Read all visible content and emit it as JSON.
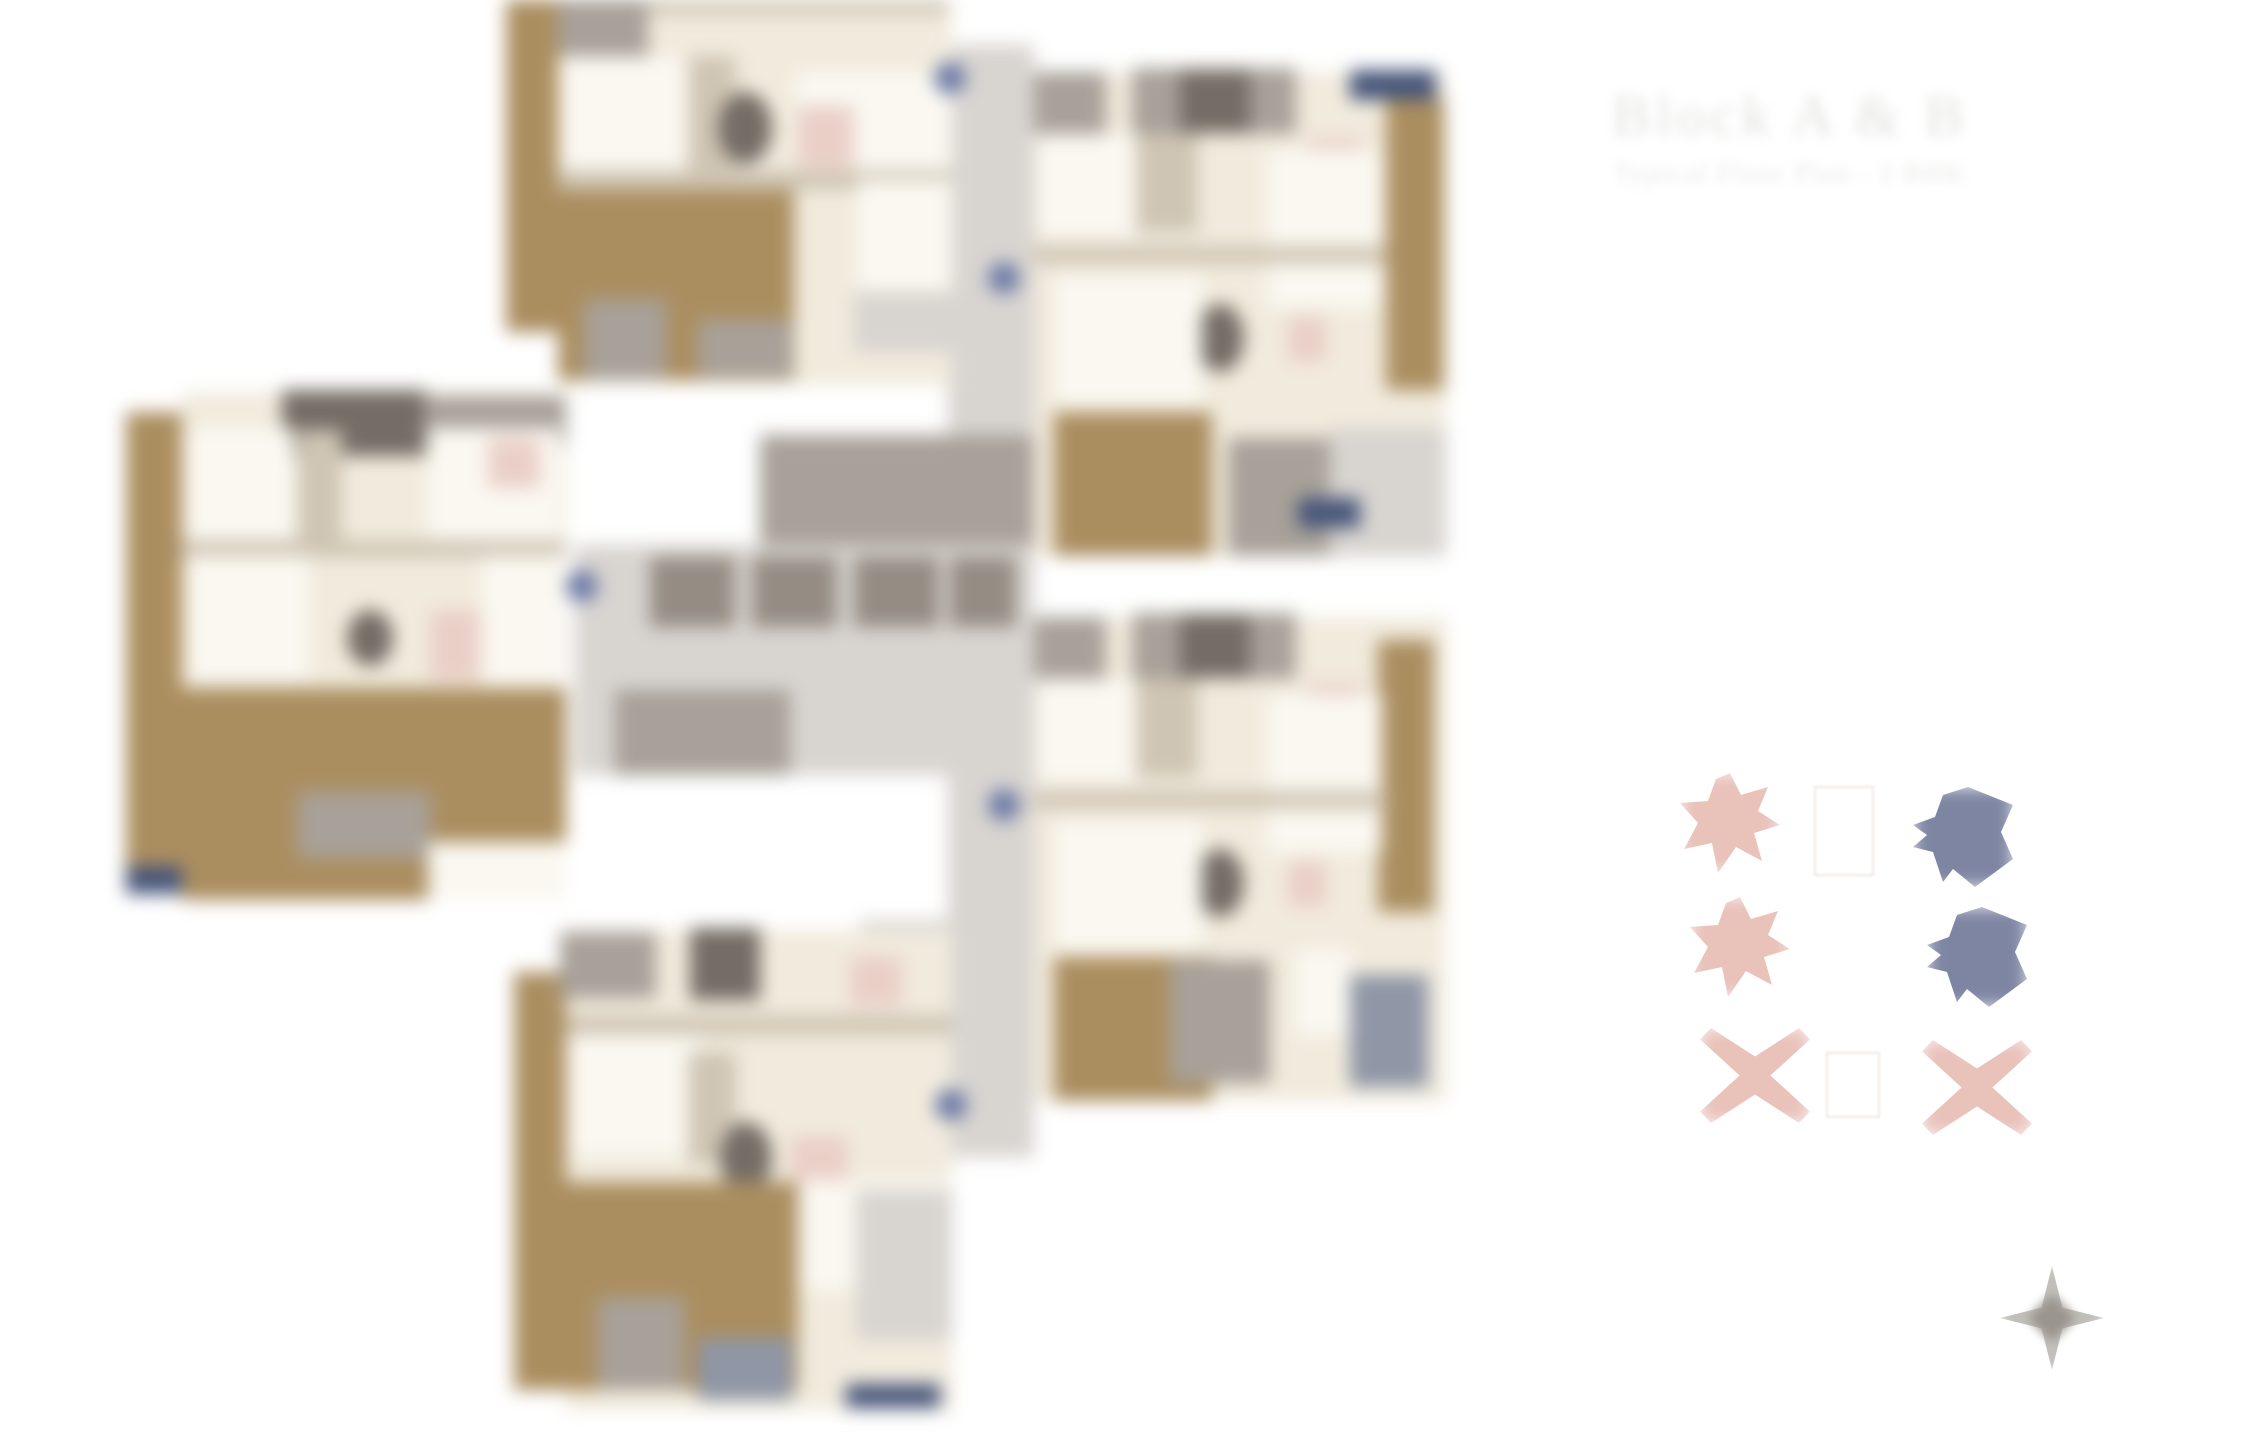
{
  "header": {
    "title": "Block A & B",
    "subtitle": "Typical Floor Plan - 2 BHK"
  },
  "palette": {
    "wood": "#ab8e60",
    "cream": "#f1ebdd",
    "cream_light": "#faf8f1",
    "wall": "#cfc5b4",
    "gray_light": "#d8d4d0",
    "gray_mid": "#a8a199",
    "gray_dark": "#746d65",
    "lift": "#958d84",
    "slate": "#8f96a6",
    "tan_gray": "#c9c0b0",
    "pink": "#eacfc7",
    "navy": "#475679",
    "badge": "#6d7ba6",
    "legend_pink": "#e9c2ba",
    "legend_blue": "#7e85a3",
    "title_color": "#e3e2e0",
    "subtitle_color": "#e8e7e5",
    "compass_outer": "#c2bfba",
    "compass_inner": "#9a958e",
    "legend_box_border": "#eeeae4",
    "page_bg": "#ffffff"
  },
  "legend": {
    "rows": [
      {
        "left_shape": "star-blob",
        "left_color": "#e9c2ba",
        "right_shape": "star-blob",
        "right_color": "#7e85a3"
      },
      {
        "left_shape": "star-blob",
        "left_color": "#e9c2ba",
        "right_shape": "star-blob",
        "right_color": "#7e85a3"
      },
      {
        "left_shape": "cross-blob",
        "left_color": "#e9c2ba",
        "right_shape": "cross-blob",
        "right_color": "#e9c2ba"
      }
    ]
  },
  "floor_plan": {
    "unit_clusters": 5,
    "entry_badge_color": "#6d7ba6"
  },
  "compass": {
    "type": "north-star"
  }
}
